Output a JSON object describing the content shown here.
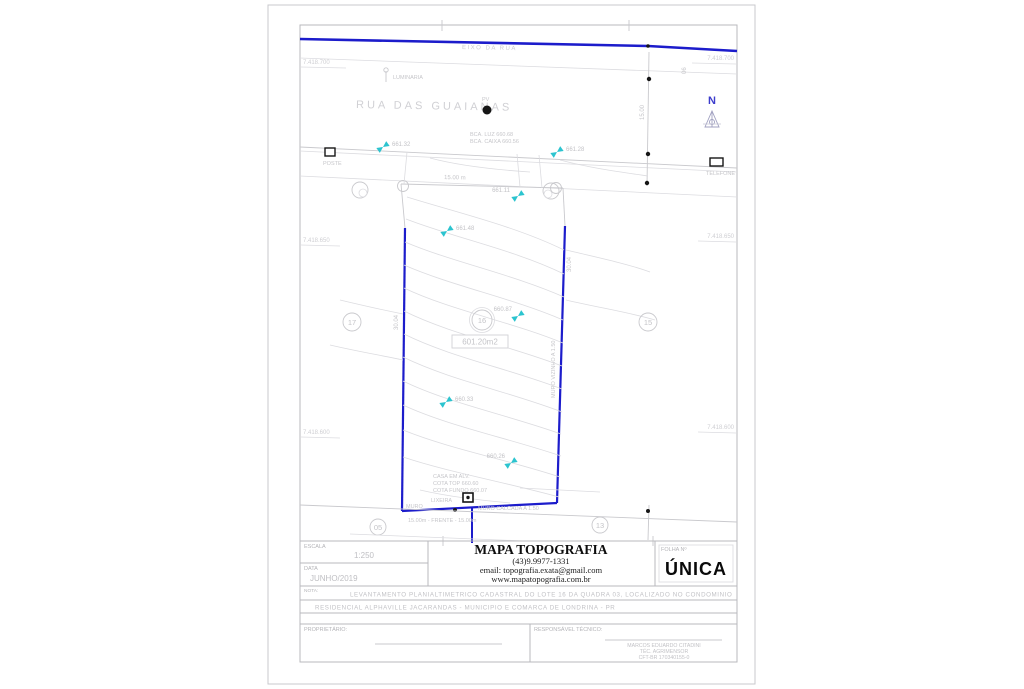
{
  "document_type": "planta-topografica",
  "colors": {
    "boundary_blue": "#1c1ccb",
    "linework_gray": "#c9c9cd",
    "marker_cyan": "#2cc4cf",
    "north_blue": "#3c3ccc",
    "paper": "#ffffff"
  },
  "map": {
    "street_name": "RUA DAS GUAIANAS",
    "top_road_label": "EIXO DA RUA",
    "north_label": "N",
    "frontage_dim": "15.00 m",
    "left_side_dim": "30.04",
    "right_side_dim": "30.04",
    "right_side_note": "MURO VIZINHO A 1.50",
    "measure_dim": "15.00",
    "corner_small": "06",
    "lot_number": "16",
    "lot_area": "601.20m2",
    "lot_left": "17",
    "lot_right": "15",
    "lot_back_left": "05",
    "lot_back_right": "13",
    "house_line1": "CASA EM ALV.",
    "house_line2": "COTA TOP 660.60",
    "house_line3": "COTA FUNDO 660.07",
    "bin_label": "LIXEIRA",
    "wall_label": "MURO",
    "wall_note": "MURO CALCADA A 1.50",
    "front_note": "15.00m - FRENTE - 15.00m",
    "pv_label": "PV",
    "lamp_label": "LUMINARIA",
    "pole_label": "POSTE",
    "phone_label": "TELEFONE",
    "utility_line1": "BCA. LUZ 660.68",
    "utility_line2": "BCA. CAIXA 660.56",
    "elevations": [
      {
        "value": "661.32"
      },
      {
        "value": "661.28"
      },
      {
        "value": "661.11"
      },
      {
        "value": "661.48"
      },
      {
        "value": "660.87"
      },
      {
        "value": "660.33"
      },
      {
        "value": "660.26"
      }
    ],
    "grid": [
      {
        "text": "7.418.700"
      },
      {
        "text": "7.418.650"
      },
      {
        "text": "7.418.600"
      }
    ]
  },
  "title_block": {
    "scale_label": "ESCALA",
    "scale_value": "1:250",
    "date_label": "DATA",
    "date_value": "JUNHO/2019",
    "company_name": "MAPA TOPOGRAFIA",
    "company_phone": "(43)9.9977-1331",
    "company_email": "email: topografia.exata@gmail.com",
    "company_site": "www.mapatopografia.com.br",
    "sheet_label": "FOLHA Nº",
    "sheet_value": "ÚNICA",
    "note_label": "NOTA:",
    "note_line1": "LEVANTAMENTO PLANIALTIMETRICO CADASTRAL DO LOTE 16 DA QUADRA 03, LOCALIZADO NO CONDOMINIO",
    "note_line2": "RESIDENCIAL ALPHAVILLE JACARANDAS - MUNICIPIO E COMARCA DE LONDRINA - PR",
    "owner_label": "PROPRIETÁRIO:",
    "tech_label": "RESPONSÁVEL TÉCNICO:",
    "tech_name": "MARCOS EDUARDO CITADINI",
    "tech_role": "TÉC. AGRIMENSOR",
    "tech_reg": "CFT-BR 170340155-0"
  }
}
